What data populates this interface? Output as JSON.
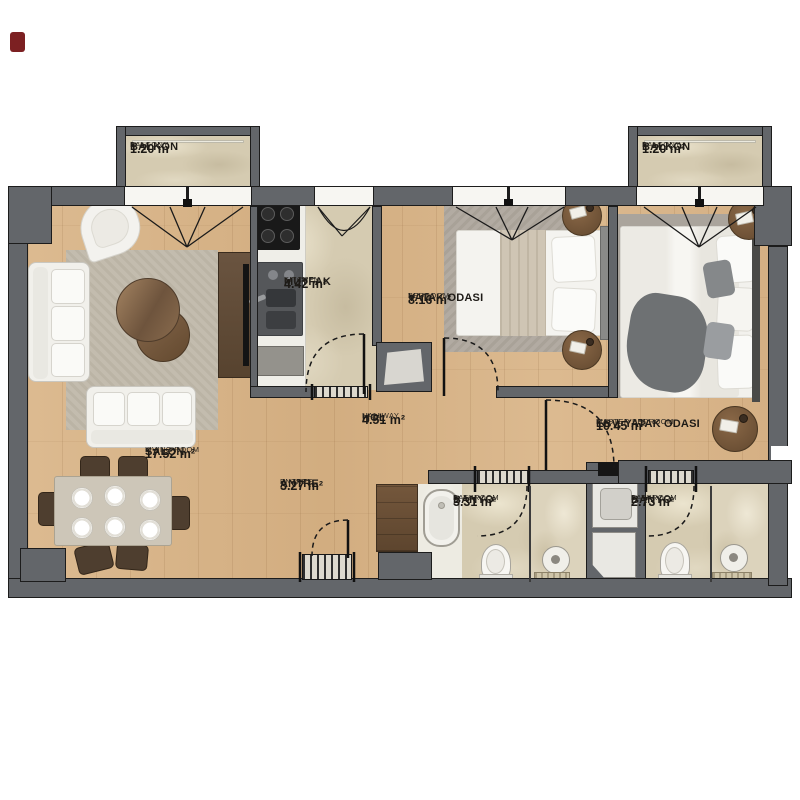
{
  "title": "apartment-floor-plan",
  "rooms": [
    {
      "id": "balcony-left",
      "name_tr": "BALKON",
      "name_en": "BALCONY",
      "area": "1.20 m"
    },
    {
      "id": "balcony-right",
      "name_tr": "BALKON",
      "name_en": "BALCONY",
      "area": "1.20 m²"
    },
    {
      "id": "kitchen",
      "name_tr": "MUTFAK",
      "name_en": "KITCHEN",
      "area": "4.42 m²"
    },
    {
      "id": "bedroom",
      "name_tr": "YATAK ODASI",
      "name_en": "BEDROOM",
      "area": "8.16 m²"
    },
    {
      "id": "living-room",
      "name_tr": "SALON",
      "name_en": "LIVING ROOM",
      "area": "17.52 m²"
    },
    {
      "id": "entrance",
      "name_tr": "ANTRE",
      "name_en": "ENTREE",
      "area": "3.27 m²"
    },
    {
      "id": "hallway",
      "name_tr": "HOL",
      "name_en": "HALLWAY",
      "area": "4.51 m²"
    },
    {
      "id": "master-bedroom",
      "name_tr": "EBV. YATAK ODASI",
      "name_en": "MASTER BEDROOM",
      "area": "10.45 m²"
    },
    {
      "id": "bathroom-1",
      "name_tr": "BANYO",
      "name_en": "BATHROOM",
      "area": "3.31 m²"
    },
    {
      "id": "bathroom-2",
      "name_tr": "BANYO",
      "name_en": "BATHROOM",
      "area": "2.73 m²"
    }
  ],
  "palette": {
    "wall": "#63666a",
    "wall_outline": "#1c1c1c",
    "wood_floor": "#d9b68c",
    "marble_floor": "#d5cbb1",
    "rug": "#c3bcae",
    "furniture_white": "#f2f1ec",
    "furniture_wood": "#7a5a3e",
    "marker": "#7c2022"
  }
}
